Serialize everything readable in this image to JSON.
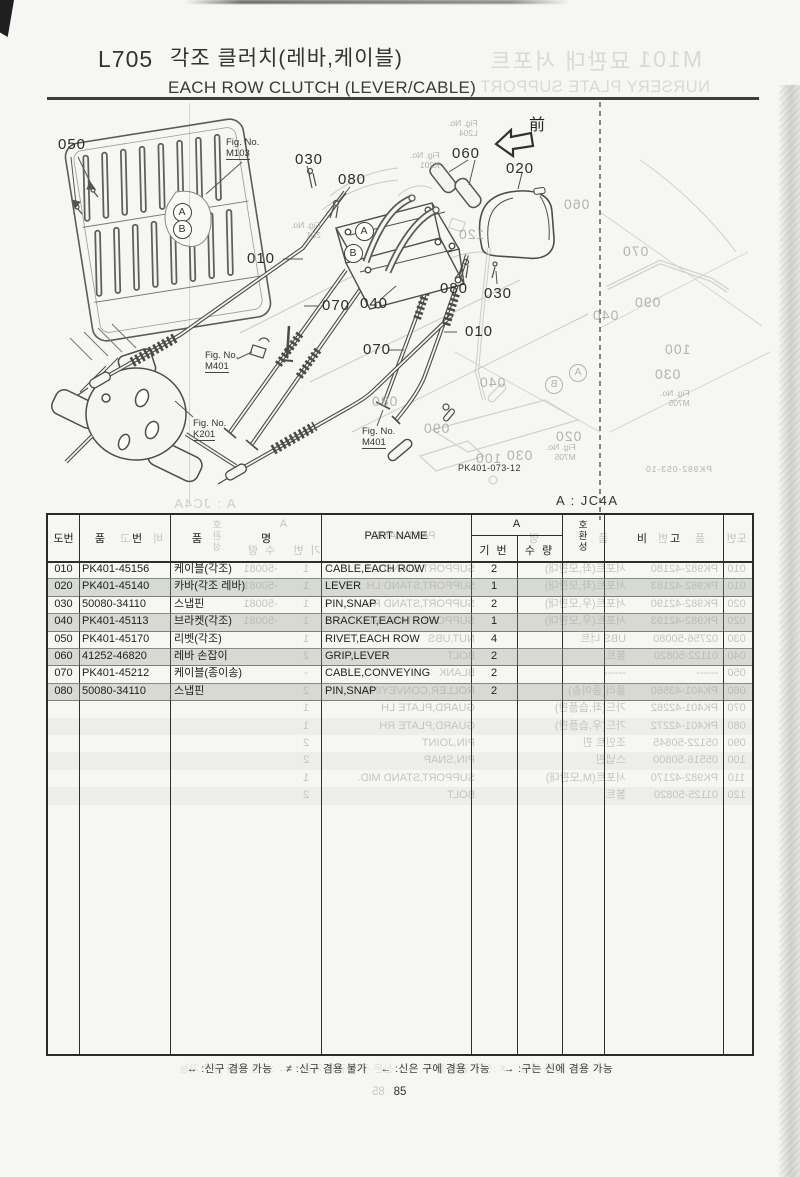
{
  "colors": {
    "paper": "#f6f6f3",
    "ink": "#2d2d2d",
    "ghost": "#98a096",
    "rule": "#3c3c3c",
    "row_shade": "rgba(164,172,158,0.30)"
  },
  "page": {
    "code": "L705",
    "title_kr": "각조 클러치(레바,케이블)",
    "title_en": "EACH ROW CLUTCH (LEVER/CABLE)",
    "applicability": "A : JC4A",
    "drawing_ref": "PK401-073-12",
    "front_marker": "前",
    "page_number": "85",
    "legend": "↔ :신구 겸용 가능    ≠ :신구 겸용 불가    ← :신은 구에 겸용 가능    → :구는 신에 겸용 가능"
  },
  "table": {
    "headers": {
      "no": "도번",
      "part_no": "품 번",
      "name_kr": "품 명",
      "part_name": "PART NAME",
      "group": "A",
      "serial": "기 번",
      "qty": "수 량",
      "compat": "호\n환\n성",
      "remarks": "비 고"
    },
    "rows": [
      {
        "no": "010",
        "part_no": "PK401-45156",
        "name_kr": "케이블(각조)",
        "part_name": "CABLE,EACH ROW",
        "qty": "2",
        "shaded": false
      },
      {
        "no": "020",
        "part_no": "PK401-45140",
        "name_kr": "카바(각조 레바)",
        "part_name": "LEVER",
        "qty": "1",
        "shaded": true
      },
      {
        "no": "030",
        "part_no": "50080-34110",
        "name_kr": "스냅핀",
        "part_name": "PIN,SNAP",
        "qty": "2",
        "shaded": false
      },
      {
        "no": "040",
        "part_no": "PK401-45113",
        "name_kr": "브라켓(각조)",
        "part_name": "BRACKET,EACH ROW",
        "qty": "1",
        "shaded": true
      },
      {
        "no": "050",
        "part_no": "PK401-45170",
        "name_kr": "리벳(각조)",
        "part_name": "RIVET,EACH ROW",
        "qty": "4",
        "shaded": false
      },
      {
        "no": "060",
        "part_no": "41252-46820",
        "name_kr": "레바 손잡이",
        "part_name": "GRIP,LEVER",
        "qty": "2",
        "shaded": true
      },
      {
        "no": "070",
        "part_no": "PK401-45212",
        "name_kr": "케이블(종이송)",
        "part_name": "CABLE,CONVEYING",
        "qty": "2",
        "shaded": false
      },
      {
        "no": "080",
        "part_no": "50080-34110",
        "name_kr": "스냅핀",
        "part_name": "PIN,SNAP",
        "qty": "2",
        "shaded": true
      }
    ]
  },
  "diagram": {
    "labels": [
      {
        "t": "050",
        "x": 58,
        "y": 137
      },
      {
        "t": "030",
        "x": 295,
        "y": 152
      },
      {
        "t": "080",
        "x": 338,
        "y": 172
      },
      {
        "t": "060",
        "x": 452,
        "y": 146
      },
      {
        "t": "020",
        "x": 506,
        "y": 161
      },
      {
        "t": "010",
        "x": 247,
        "y": 251
      },
      {
        "t": "070",
        "x": 322,
        "y": 298
      },
      {
        "t": "040",
        "x": 360,
        "y": 296
      },
      {
        "t": "070",
        "x": 363,
        "y": 342
      },
      {
        "t": "080",
        "x": 440,
        "y": 281
      },
      {
        "t": "030",
        "x": 484,
        "y": 286
      },
      {
        "t": "010",
        "x": 465,
        "y": 324
      }
    ],
    "circled": [
      {
        "t": "A",
        "cx": 181,
        "cy": 211
      },
      {
        "t": "B",
        "cx": 181,
        "cy": 228
      },
      {
        "t": "A",
        "cx": 363,
        "cy": 230
      },
      {
        "t": "B",
        "cx": 352,
        "cy": 252
      }
    ],
    "fig_refs": [
      {
        "l1": "Fig. No.",
        "l2": "M103",
        "x": 226,
        "y": 137
      },
      {
        "l1": "Fig. No.",
        "l2": "M401",
        "x": 205,
        "y": 350
      },
      {
        "l1": "Fig. No.",
        "l2": "K201",
        "x": 193,
        "y": 418
      },
      {
        "l1": "Fig. No.",
        "l2": "M401",
        "x": 362,
        "y": 426
      }
    ]
  },
  "ghost": {
    "title": {
      "code": "M101",
      "title_kr": "묘판대 서포트",
      "title_en": "NURSERY PLATE SUPPORT"
    },
    "applicability": "A : JC4A",
    "ref": "PK982-053-10",
    "page_number": "85",
    "diagram_labels": [
      {
        "t": "060",
        "x": 563,
        "y": 196
      },
      {
        "t": "120",
        "x": 458,
        "y": 226
      },
      {
        "t": "070",
        "x": 622,
        "y": 243
      },
      {
        "t": "090",
        "x": 634,
        "y": 294
      },
      {
        "t": "040",
        "x": 592,
        "y": 307
      },
      {
        "t": "100",
        "x": 664,
        "y": 341
      },
      {
        "t": "030",
        "x": 654,
        "y": 366
      },
      {
        "t": "080",
        "x": 371,
        "y": 393
      },
      {
        "t": "090",
        "x": 423,
        "y": 420
      },
      {
        "t": "040",
        "x": 479,
        "y": 374
      },
      {
        "t": "100",
        "x": 475,
        "y": 450
      },
      {
        "t": "030",
        "x": 506,
        "y": 447
      },
      {
        "t": "020",
        "x": 555,
        "y": 428
      }
    ],
    "fig_refs": [
      {
        "l1": "Fig. No.",
        "l2": "M705",
        "x": 546,
        "y": 443
      },
      {
        "l1": "Fig. No.",
        "l2": "M705",
        "x": 660,
        "y": 389
      },
      {
        "l1": "Fig. No.",
        "l2": "L204",
        "x": 448,
        "y": 119
      },
      {
        "l1": "Fig. No.",
        "l2": "K201",
        "x": 410,
        "y": 151
      },
      {
        "l1": "Fig. No.",
        "l2": "201",
        "x": 291,
        "y": 221
      }
    ],
    "circled": [
      {
        "t": "A",
        "cx": 577,
        "cy": 372
      },
      {
        "t": "B",
        "cx": 553,
        "cy": 384
      }
    ],
    "rows": [
      {
        "no": "010",
        "part_no": "PK982-42180",
        "name_kr": "서포트(좌,모판대)",
        "part_name": "SUPPORT,STAND LH",
        "qty": "1",
        "tail": "-50081",
        "shaded": false
      },
      {
        "no": "010",
        "part_no": "PK982-42183",
        "name_kr": "서포트(좌,모판대)",
        "part_name": "SUPPORT,STAND LH",
        "qty": "1",
        "tail": "-50081",
        "shaded": true
      },
      {
        "no": "020",
        "part_no": "PK982-42190",
        "name_kr": "서포트(우,모판대)",
        "part_name": "SUPPORT,STAND RH",
        "qty": "1",
        "tail": "-50081",
        "shaded": false
      },
      {
        "no": "020",
        "part_no": "PK982-42193",
        "name_kr": "서포트(우,모판대)",
        "part_name": "SUPPORT,STAND RH",
        "qty": "1",
        "tail": "-50081",
        "shaded": true
      },
      {
        "no": "030",
        "part_no": "02756-50080",
        "name_kr": "UBS 너트",
        "part_name": "NUT,UBS",
        "qty": "1",
        "tail": "",
        "shaded": false
      },
      {
        "no": "040",
        "part_no": "01122-50820",
        "name_kr": "볼트",
        "part_name": "BOLT",
        "qty": "2",
        "tail": "",
        "shaded": true
      },
      {
        "no": "050",
        "part_no": "------",
        "name_kr": "------",
        "part_name": "BLANK",
        "qty": "-",
        "tail": "",
        "shaded": false
      },
      {
        "no": "060",
        "part_no": "PK401-43560",
        "name_kr": "롤러(종이송)",
        "part_name": "ROLLER,CONVEYING",
        "qty": "2",
        "tail": "",
        "shaded": true
      },
      {
        "no": "070",
        "part_no": "PK401-42262",
        "name_kr": "가드(좌,습플판)",
        "part_name": "GUARD,PLATE LH",
        "qty": "1",
        "tail": "",
        "shaded": false
      },
      {
        "no": "080",
        "part_no": "PK401-42272",
        "name_kr": "가드(우,습플판)",
        "part_name": "GUARD,PLATE RH",
        "qty": "1",
        "tail": "",
        "shaded": true
      },
      {
        "no": "090",
        "part_no": "05122-50845",
        "name_kr": "조인트 핀",
        "part_name": "PIN,JOINT",
        "qty": "2",
        "tail": "",
        "shaded": false
      },
      {
        "no": "100",
        "part_no": "05516-50800",
        "name_kr": "스냅핀",
        "part_name": "PIN,SNAP",
        "qty": "2",
        "tail": "",
        "shaded": true
      },
      {
        "no": "110",
        "part_no": "PK982-42170",
        "name_kr": "서포트(M,모판대)",
        "part_name": "SUPPORT,STAND MID.",
        "qty": "1",
        "tail": "",
        "shaded": false
      },
      {
        "no": "120",
        "part_no": "01125-50820",
        "name_kr": "볼트",
        "part_name": "BOLT",
        "qty": "2",
        "tail": "",
        "shaded": true
      }
    ]
  }
}
